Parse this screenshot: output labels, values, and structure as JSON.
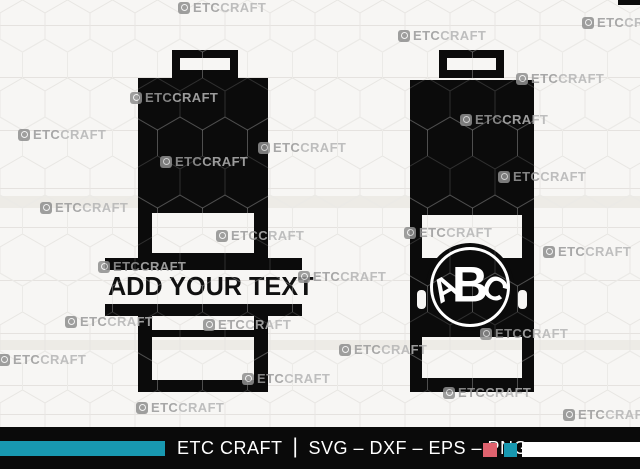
{
  "canvas": {
    "width": 640,
    "height": 469,
    "background": "#f7f6f4",
    "silhouette_color": "#0b0b0b",
    "hex_line_light": "#e4e2de",
    "hex_line_on_black": "rgba(255,255,255,0.15)"
  },
  "designs": {
    "left": {
      "name": "split monogram battery",
      "text": "ADD YOUR TEXT"
    },
    "right": {
      "name": "circle monogram battery",
      "monogram": [
        "A",
        "B",
        "C"
      ]
    }
  },
  "watermark": {
    "full_text": "ETCCRAFT",
    "text_bold": "ETC",
    "text_light": "CRAFT",
    "positions": [
      [
        178,
        0
      ],
      [
        582,
        15
      ],
      [
        398,
        28
      ],
      [
        130,
        90
      ],
      [
        516,
        71
      ],
      [
        460,
        112
      ],
      [
        18,
        127
      ],
      [
        160,
        154
      ],
      [
        258,
        140
      ],
      [
        498,
        169
      ],
      [
        40,
        200
      ],
      [
        216,
        228
      ],
      [
        404,
        225
      ],
      [
        543,
        244
      ],
      [
        98,
        259
      ],
      [
        298,
        269
      ],
      [
        65,
        314
      ],
      [
        203,
        317
      ],
      [
        339,
        342
      ],
      [
        480,
        326
      ],
      [
        -2,
        352
      ],
      [
        242,
        371
      ],
      [
        136,
        400
      ],
      [
        443,
        385
      ],
      [
        563,
        407
      ]
    ]
  },
  "footer": {
    "brand": "ETC CRAFT",
    "separator": "|",
    "formats": "SVG – DXF – EPS – PNG",
    "background": "#0a0a0a",
    "teal": "#1898B0",
    "red": "#DF626E",
    "white": "#ffffff",
    "text_color": "#ffffff"
  }
}
